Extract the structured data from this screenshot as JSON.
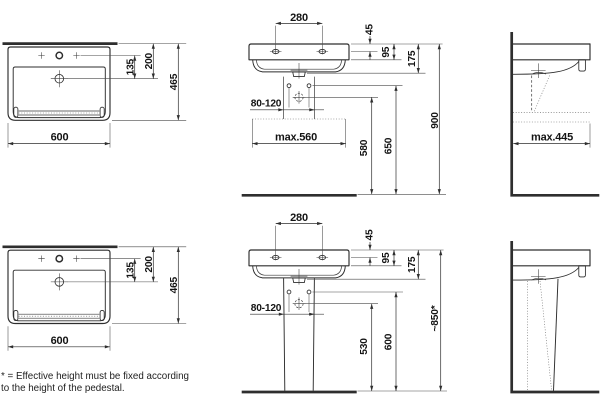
{
  "sheet": {
    "top": {
      "plan": {
        "width": "600",
        "depth": "465",
        "drain_offset": "135",
        "drain_from_wall": "200"
      },
      "front": {
        "tap_spacing": "280",
        "edge_to_tap": "45",
        "rim_height": "95",
        "basin_height": "175",
        "bolt_spacing": "80-120",
        "max_width": "max.560",
        "siphon_height": "580",
        "bolt_height": "650",
        "overall_height": "900"
      },
      "side": {
        "max_depth": "max.445"
      }
    },
    "bottom": {
      "plan": {
        "width": "600",
        "depth": "465",
        "drain_offset": "135",
        "drain_from_wall": "200"
      },
      "front": {
        "tap_spacing": "280",
        "edge_to_tap": "45",
        "rim_height": "95",
        "bolt_spacing": "80-120",
        "siphon_height": "530",
        "bolt_height": "600"
      },
      "side": {
        "basin_height": "175",
        "overall_height": "~850*"
      }
    }
  },
  "footnote": {
    "line1": "* = Effective height must be fixed according",
    "line2": "to the height of the pedestal."
  },
  "colors": {
    "line": "#2e2e2e",
    "text": "#141414",
    "background": "#ffffff"
  }
}
